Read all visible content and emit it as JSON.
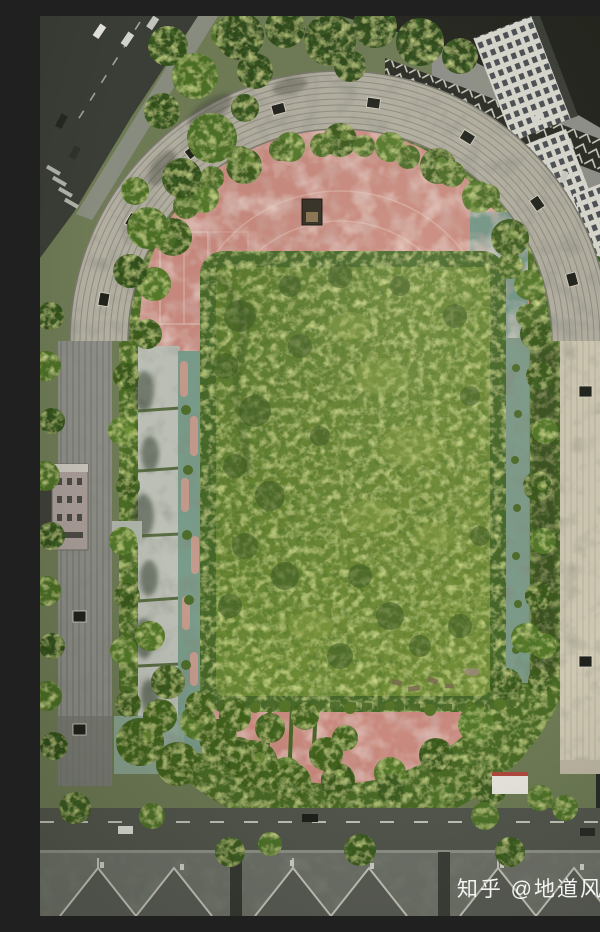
{
  "meta": {
    "type": "aerial-drone-photograph",
    "subject": "abandoned-overgrown-stadium",
    "view": "top-down"
  },
  "watermark": {
    "text": "知乎 @地道风物"
  },
  "palette": {
    "track_pink": "#c9897e",
    "track_pink_light": "#dba99b",
    "field_green": "#677f31",
    "foliage_dark": "#3a581e",
    "foliage_mid": "#4c6a28",
    "foliage_light": "#7e9c3e",
    "stand_concrete": "#b2afa1",
    "stand_left_grey": "#8d8e87",
    "stand_right_beige": "#cec8b3",
    "walkway_grey": "#bcc0b6",
    "court_teal": "#729687",
    "road_dark": "#3a3e36",
    "road_mid": "#53574d",
    "roof_grey": "#70736b",
    "roof_dark": "#23251e",
    "building_white": "#d9d9d0",
    "watermark_white": "#ffffff"
  },
  "scene": {
    "regions": {
      "stadium": "oval stadium with concrete grandstands",
      "track": "faded pink running track",
      "infield": "rectangular infield fully overgrown with dense weeds",
      "vegetation_ring": "trees and brush growing between stands and track",
      "courts": "teal sport courts with faint white lines",
      "rostrum": "reviewing stand on west side",
      "surroundings": "city roads, parked cars, apartment buildings, grey hip rooftops"
    }
  }
}
